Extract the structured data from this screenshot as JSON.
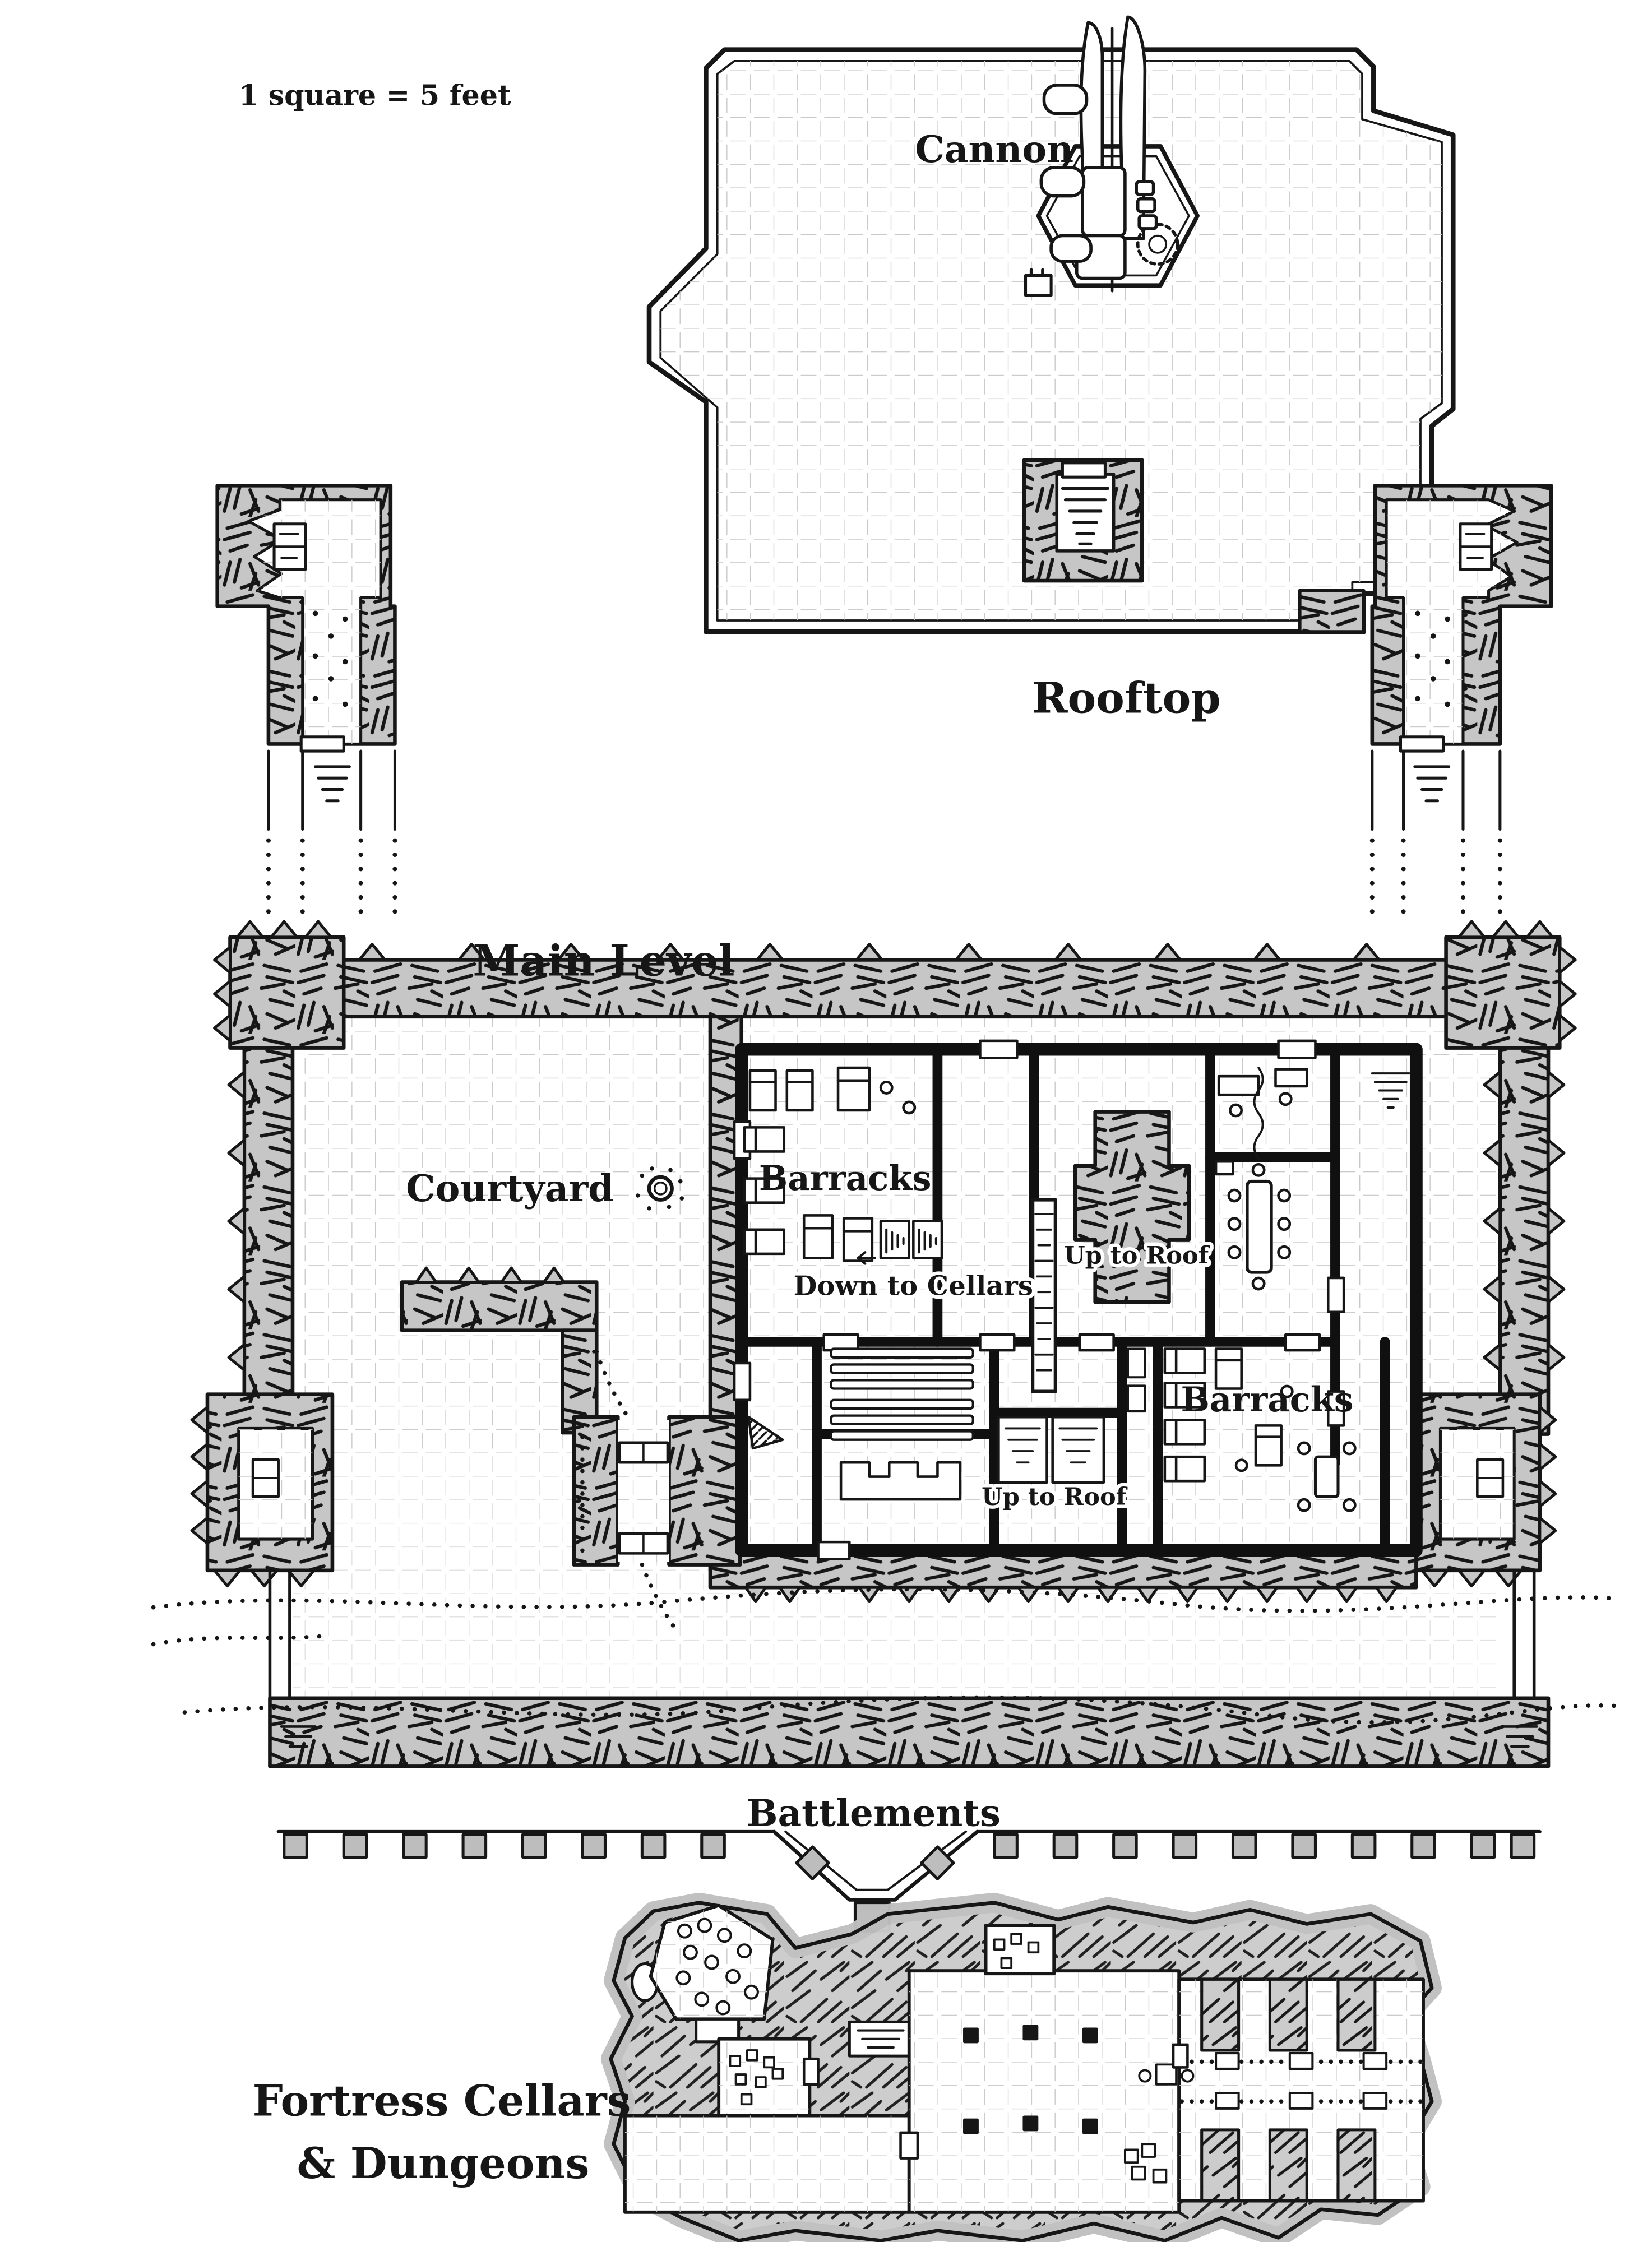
{
  "map": {
    "scale_note": "1 square = 5 feet",
    "colors": {
      "paper": "#ffffff",
      "ink": "#161616",
      "wall_gray": "#c6c6c6",
      "grid_line": "#c9c9c9",
      "merlon_gray": "#bdbdbd"
    },
    "rooftop": {
      "label": "Rooftop",
      "cannon": "Cannon"
    },
    "main_level": {
      "label": "Main Level",
      "courtyard": "Courtyard",
      "barracks_north": "Barracks",
      "barracks_south": "Barracks",
      "up_to_roof_north": "Up to Roof",
      "up_to_roof_south": "Up to Roof",
      "down_to_cellars": "Down to Cellars",
      "battlements": "Battlements"
    },
    "cellars": {
      "label_line1": "Fortress Cellars",
      "label_line2": "& Dungeons"
    }
  }
}
